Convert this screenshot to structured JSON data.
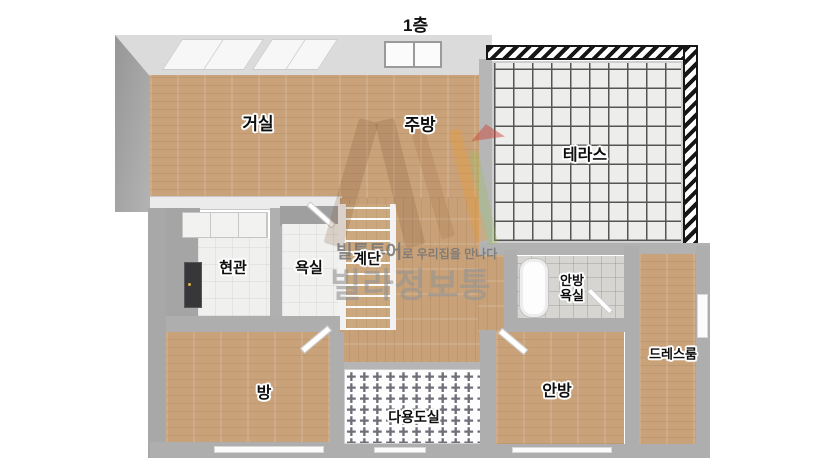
{
  "page": {
    "title": "1층"
  },
  "floorplan": {
    "rooms": {
      "living": {
        "label": "거실"
      },
      "kitchen": {
        "label": "주방"
      },
      "terrace": {
        "label": "테라스"
      },
      "entrance": {
        "label": "현관"
      },
      "bathroom": {
        "label": "욕실"
      },
      "stairs": {
        "label": "계단"
      },
      "master_bathroom": {
        "label_line1": "안방",
        "label_line2": "욕실"
      },
      "dressroom": {
        "label": "드레스룸"
      },
      "room": {
        "label": "방"
      },
      "utility": {
        "label": "다용도실",
        "pattern_glyph": "✚"
      },
      "master_bedroom": {
        "label": "안방"
      }
    },
    "colors": {
      "wood_floor": "#c9a27a",
      "wall_gray": "#aeaeae",
      "terrace_tile": "#ededeb",
      "entrance_door": "#37373a",
      "watermark_gray": "#949494",
      "watermark_orange": "#eb9b2d"
    }
  },
  "watermark": {
    "brand": "빌통투어",
    "tagline": "로 우리집을 만나다",
    "name": "빌라정보통"
  }
}
